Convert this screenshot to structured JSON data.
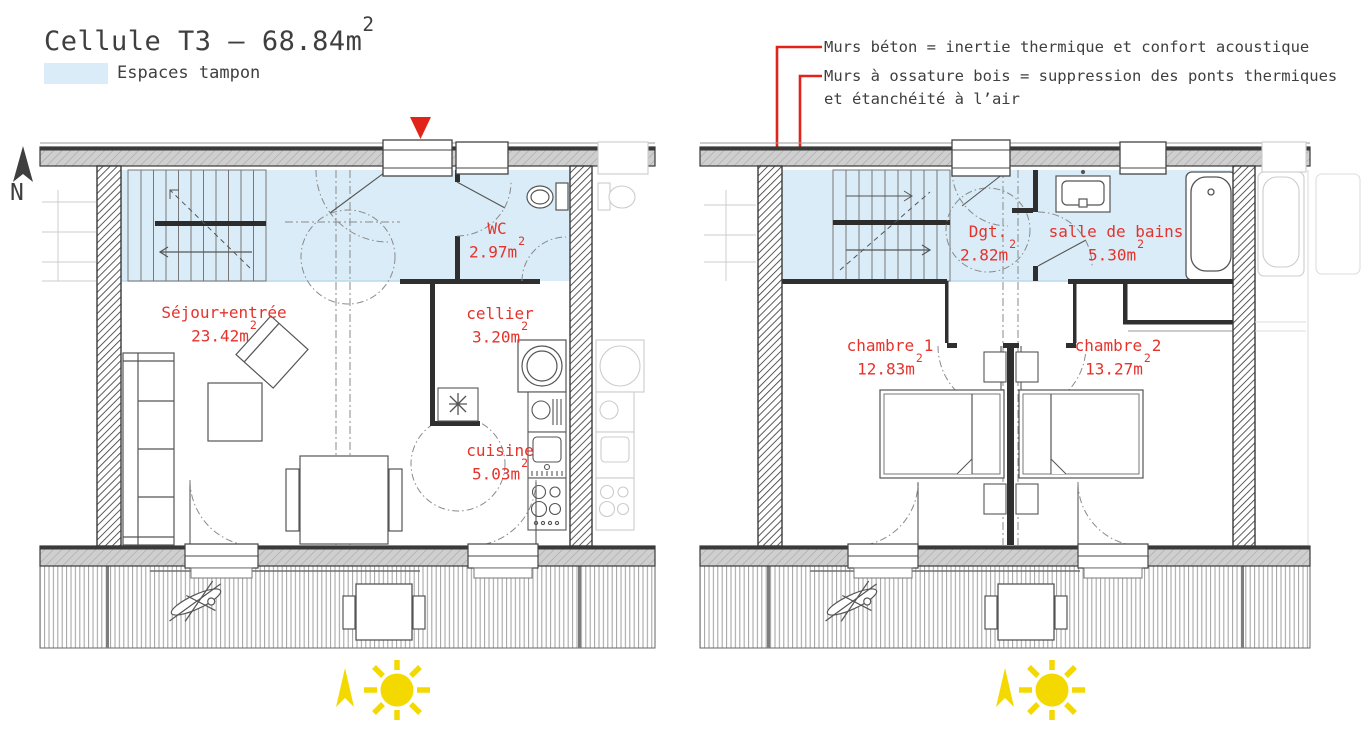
{
  "title": {
    "text": "Cellule T3 – 68.84m",
    "sup": "2"
  },
  "legend": {
    "label": "Espaces tampon",
    "swatch_color": "#d9ecf7"
  },
  "annotations": {
    "concrete": "Murs béton = inertie thermique et confort acoustique",
    "wood_line1": "Murs à ossature bois = suppression des ponts thermiques",
    "wood_line2": "et étanchéité à l’air"
  },
  "compass": {
    "label": "N"
  },
  "plans": {
    "ground": {
      "name": "ground-floor",
      "rooms": [
        {
          "name": "Séjour+entrée",
          "area": "23.42m",
          "sup": "2"
        },
        {
          "name": "WC",
          "area": "2.97m",
          "sup": "2"
        },
        {
          "name": "cellier",
          "area": "3.20m",
          "sup": "2"
        },
        {
          "name": "cuisine",
          "area": "5.03m",
          "sup": "2"
        }
      ]
    },
    "upper": {
      "name": "upper-floor",
      "rooms": [
        {
          "name": "Dgt.",
          "area": "2.82m",
          "sup": "2"
        },
        {
          "name": "salle de bains",
          "area": "5.30m",
          "sup": "2"
        },
        {
          "name": "chambre 1",
          "area": "12.83m",
          "sup": "2"
        },
        {
          "name": "chambre 2",
          "area": "13.27m",
          "sup": "2"
        }
      ]
    }
  },
  "colors": {
    "buffer_blue": "#d9ecf7",
    "label_red": "#e5332c",
    "line_red": "#e2231a",
    "sun_yellow": "#f3d900",
    "wall_dark": "#3a3a3a",
    "text_gray": "#3f3f3f"
  }
}
